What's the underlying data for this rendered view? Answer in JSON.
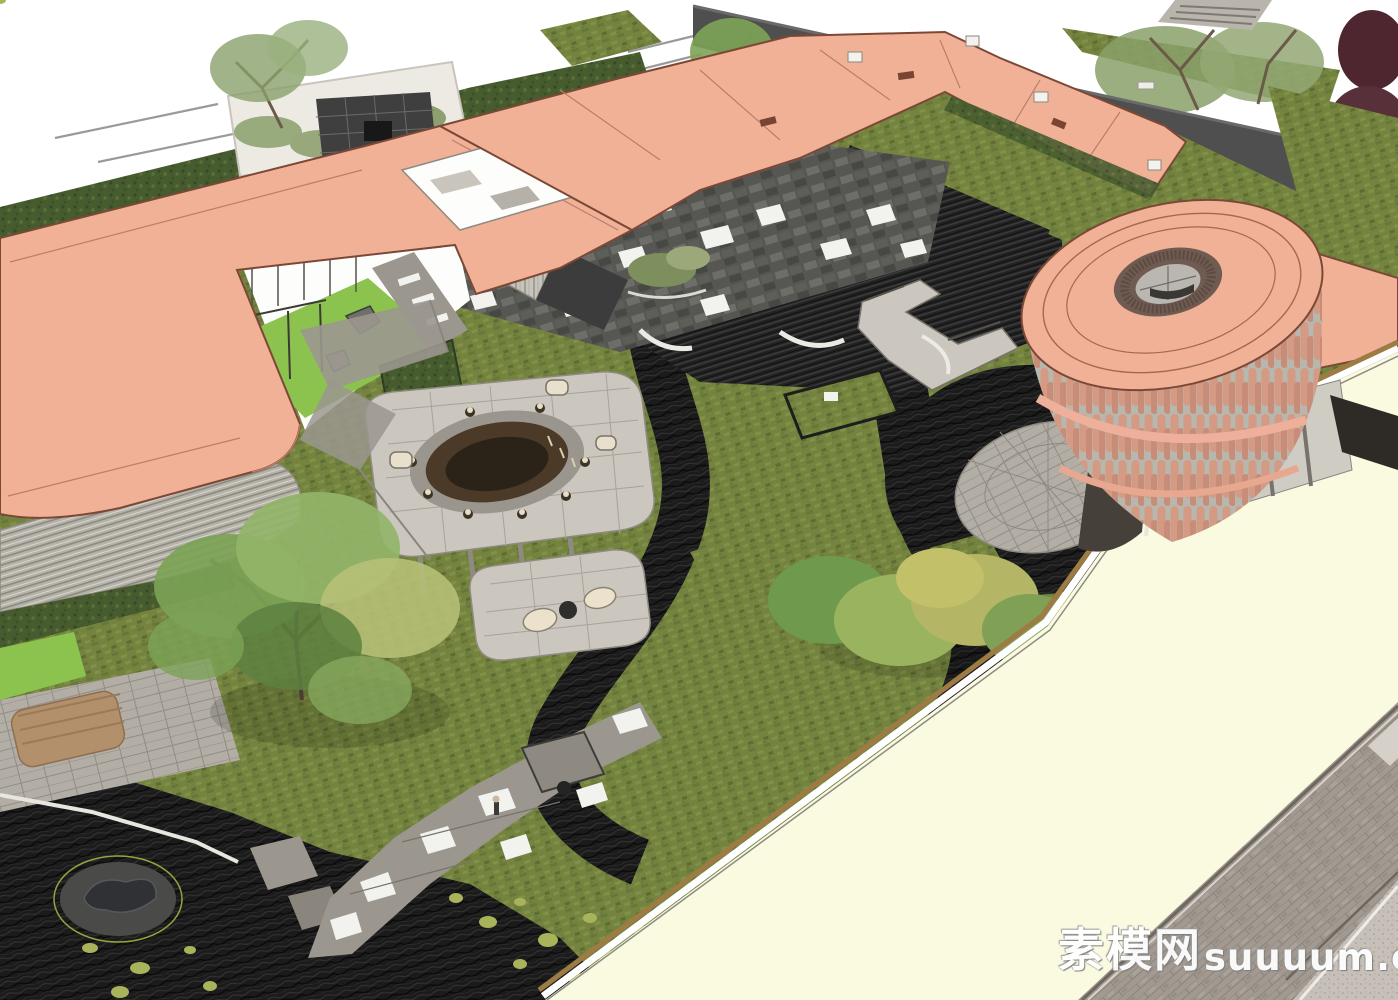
{
  "watermark": {
    "cjk": "素模网",
    "latin": "suuuum.com"
  },
  "scene": {
    "type": "3d-architectural-render",
    "description": "Aerial axonometric SketchUp-style rendering of a residential show-area courtyard landscape: salmon-pink flat roofs and a round drum tower enclose a sunken garden of wild meadow grass, charred-black water ravines, stone terraces with a circular bronze bar, winding paver paths, lawns and specimen trees; a cream roof band and grey brick street border the lower right.",
    "elements": [
      {
        "name": "street-lane-markings",
        "color": "#9a9a9a"
      },
      {
        "name": "roadside-hedge-verge",
        "color": "#4a5e2f"
      },
      {
        "name": "planting-island-left",
        "color": "#8aa06a"
      },
      {
        "name": "tree-grate-plaza",
        "color": "#3f3f3f"
      },
      {
        "name": "planting-island-right",
        "color": "#8aa06a"
      },
      {
        "name": "boundary-wall-dark",
        "color": "#4f4f4f"
      },
      {
        "name": "neighbor-striped-roof",
        "color": "#b9b5ad"
      },
      {
        "name": "red-maple-trees",
        "color": "#4e2630"
      },
      {
        "name": "meadow-ground",
        "color": "#74843e"
      },
      {
        "name": "charcoal-water-ravines",
        "color": "#1d1d1d"
      },
      {
        "name": "sunken-terrace-steps",
        "color": "#262626"
      },
      {
        "name": "checker-paver-plaza",
        "color": "#565652"
      },
      {
        "name": "stone-foot-bridge",
        "color": "#c6c2ba"
      },
      {
        "name": "entry-gate-striped-wall",
        "color": "#c7c4bc"
      },
      {
        "name": "curved-white-benches",
        "color": "#eceae4"
      },
      {
        "name": "lawn-courtyard-with-swings",
        "color": "#8cc34f"
      },
      {
        "name": "central-stone-terrace",
        "color": "#cbc7bf"
      },
      {
        "name": "round-bronze-bar-counter",
        "color": "#4a3a27"
      },
      {
        "name": "bar-stools",
        "color": "#e8ddc4"
      },
      {
        "name": "lounge-terrace",
        "color": "#cbc7bf"
      },
      {
        "name": "big-specimen-tree",
        "color": "#7ca356"
      },
      {
        "name": "yellow-green-tree-cluster",
        "color": "#b5b566"
      },
      {
        "name": "paver-path-with-white-slabs",
        "color": "#9b978f"
      },
      {
        "name": "garden-pavilion",
        "color": "#8e8a81"
      },
      {
        "name": "left-louver-facade-building",
        "color": "#b5b2aa"
      },
      {
        "name": "timber-deck",
        "color": "#b3906c"
      },
      {
        "name": "black-pond-with-sculpture",
        "color": "#1d1d1d"
      },
      {
        "name": "whale-sculpture",
        "color": "#2f3134"
      },
      {
        "name": "lily-pads",
        "color": "#a9b45a"
      },
      {
        "name": "salmon-roof-left-block",
        "color": "#f0b197"
      },
      {
        "name": "salmon-canopy-walkway",
        "color": "#f0b197"
      },
      {
        "name": "round-drum-tower",
        "color": "#d69b85"
      },
      {
        "name": "tower-roof-oculus",
        "color": "#6f5b51"
      },
      {
        "name": "tower-circular-plaza",
        "color": "#b2aea6"
      },
      {
        "name": "cream-roof-band",
        "color": "#fafae1"
      },
      {
        "name": "gold-roof-trim",
        "color": "#9d7b43"
      },
      {
        "name": "brick-street",
        "color": "#a29a91"
      },
      {
        "name": "concrete-corner-pavement",
        "color": "#c6c0b8"
      }
    ]
  },
  "palette": {
    "page_bg": "#ffffff",
    "roof_salmon": "#f0b197",
    "roof_salmon_edge": "#7c4836",
    "roof_cream": "#fafae1",
    "trim_gold": "#9d7b43",
    "tower_slat": "#d69b85",
    "tower_base": "#b7b7ad",
    "roof_ring_hole": "#6f5b51",
    "wall_dark": "#4f4f4f",
    "meadow_green": "#74843e",
    "lawn_green": "#8cc34f",
    "hedge_green": "#4a5e2f",
    "charcoal": "#1d1d1d",
    "paving_gray": "#9b978f",
    "paving_white": "#f2f2ef",
    "checker_dark": "#565652",
    "street_brick": "#a29a91",
    "stone_light": "#cbc7bf",
    "bronze_dark": "#4a3a27",
    "tree_green": "#7ca356",
    "tree_yellow": "#b5b566",
    "tree_olive": "#8aa06a",
    "tree_red": "#4e2630",
    "deck_wood": "#b3906c",
    "lilypad": "#a9b45a",
    "watermark_fill": "#ffffff"
  }
}
